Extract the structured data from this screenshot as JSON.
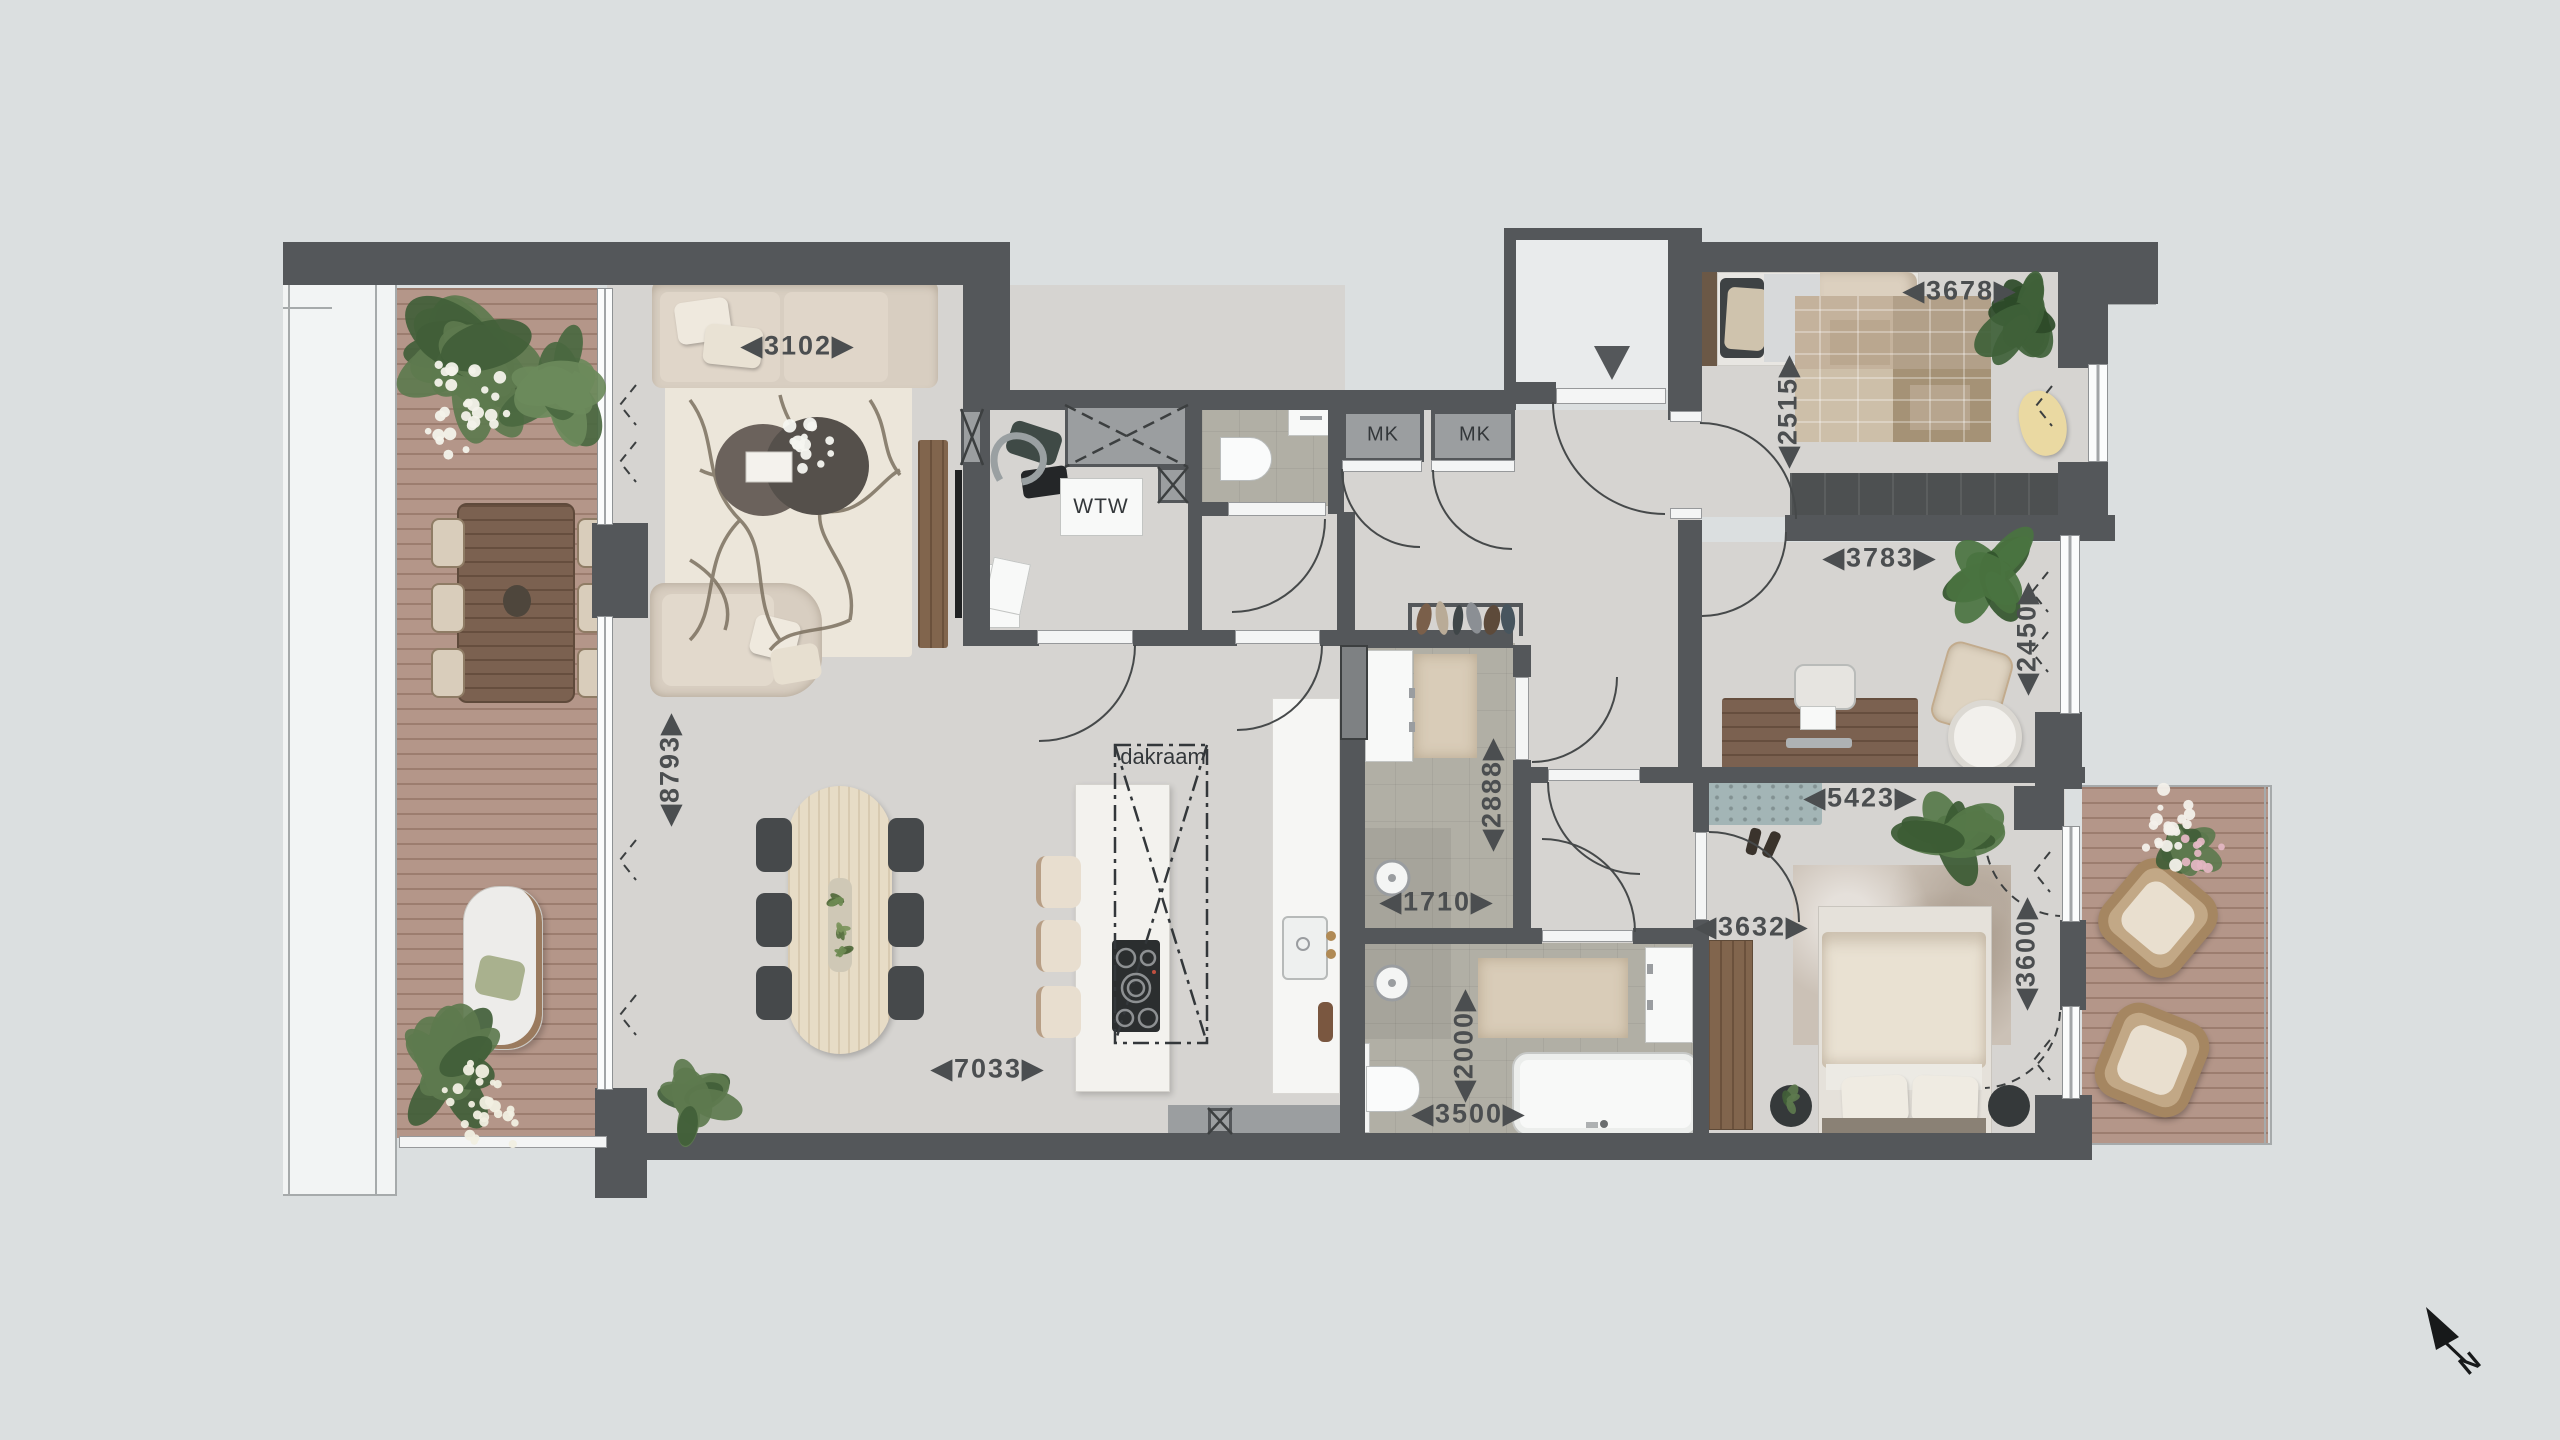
{
  "compass": {
    "label": "N"
  },
  "annotations": {
    "roof_window": "dakraam",
    "heat_recovery_unit": "WTW",
    "meter_cupboard_left": "MK",
    "meter_cupboard_right": "MK"
  },
  "dimensions": {
    "living_width": "◀3102▶",
    "living_length": "◀8793▶",
    "open_plan_width": "◀7033▶",
    "bathroom1_width": "◀1710▶",
    "bathroom1_depth": "◀2888▶",
    "bathroom2_depth": "◀2000▶",
    "bathroom2_width": "◀3500▶",
    "master_bedroom_width": "◀3632▶",
    "master_bedroom_span": "◀5423▶",
    "master_bedroom_depth": "◀3600▶",
    "study_width": "◀3783▶",
    "study_depth": "◀2450▶",
    "bedroom2_depth": "◀2515▶",
    "bedroom2_width": "◀3678▶"
  },
  "colors": {
    "wall": "#54575a",
    "floor_concrete": "#d6d4d1",
    "deck_wood": "#b49689",
    "tile": "#b1afa5",
    "background": "#dbdfe0",
    "plant_green": "#5d7a4e",
    "bench_blue": "#a3b5b6",
    "dimension_text": "#4b4e50"
  }
}
